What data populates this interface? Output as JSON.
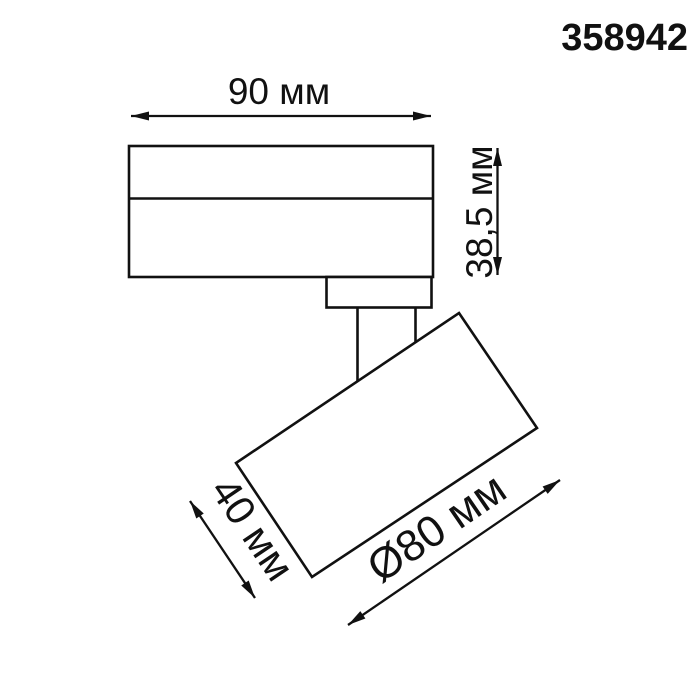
{
  "product": {
    "code": "358942"
  },
  "dimensions": {
    "track_width": "90 мм",
    "base_height": "38,5 мм",
    "head_depth": "40 мм",
    "head_diameter": "Ø80 мм"
  },
  "colors": {
    "line": "#111111",
    "background": "#ffffff"
  }
}
